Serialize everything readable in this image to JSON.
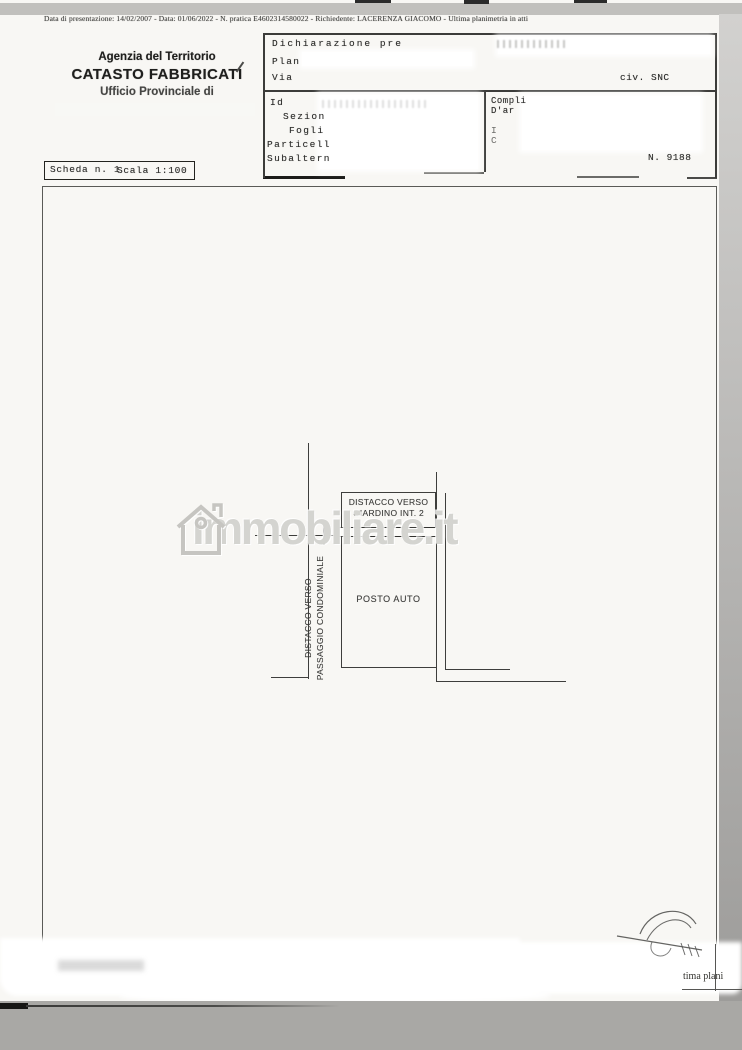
{
  "meta_line": "Data di presentazione: 14/02/2007 - Data: 01/06/2022 - N. pratica E4602314580022 - Richiedente: LACERENZA GIACOMO - Ultima planimetria in atti",
  "header": {
    "agency": "Agenzia del Territorio",
    "registry": "CATASTO FABBRICATI",
    "office": "Ufficio Provinciale di"
  },
  "form": {
    "declaration_label": "Dichiarazione pre",
    "plan_label": "Plan",
    "street_label": "Via",
    "civic_value": "civ. SNC",
    "identifiers_label": "Id",
    "section_label": "Sezion",
    "sheet_label": "Fogli",
    "parcel_label": "Particell",
    "subunit_label": "Subaltern",
    "complex_label_line1": "Compli",
    "complex_label_line2": "D'ar",
    "right_partial_1": "I",
    "right_partial_2": "C",
    "protocol_number": "N. 9188"
  },
  "sheet_info": {
    "sheet_label": "Scheda n. 1",
    "scale_label": "Scala 1:100"
  },
  "floor_plan": {
    "garden_setback_line1": "DISTACCO VERSO",
    "garden_setback_line2": "GIARDINO INT. 2",
    "parking_label": "POSTO AUTO",
    "passage_setback_line1": "DISTACCO VERSO",
    "passage_setback_line2": "PASSAGGIO CONDOMINIALE"
  },
  "watermark": {
    "brand": "immobiliare.it"
  },
  "footer": {
    "partial_text": "tima plani"
  },
  "colors": {
    "paper": "#f8f7f4",
    "scanner_gray": "#a9a8a6",
    "ink": "#2e2e2c",
    "plan_line": "#3e3e3c",
    "watermark_gray": "#cbcac6"
  }
}
